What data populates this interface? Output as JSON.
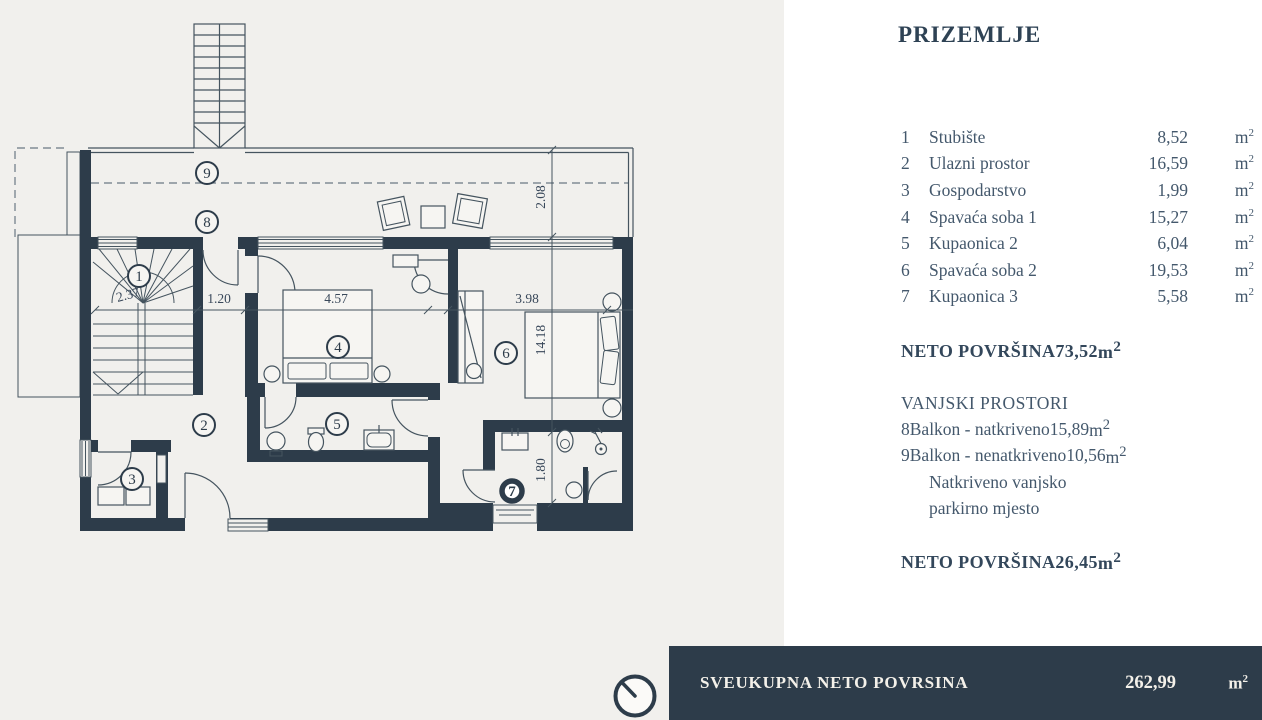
{
  "page": {
    "background": "#f1f0ed",
    "accent": "#2d3c4a"
  },
  "panel": {
    "title": "PRIZEMLJE",
    "rooms": [
      {
        "num": "1",
        "name": "Stubište",
        "area": "8,52"
      },
      {
        "num": "2",
        "name": "Ulazni prostor",
        "area": "16,59"
      },
      {
        "num": "3",
        "name": "Gospodarstvo",
        "area": "1,99"
      },
      {
        "num": "4",
        "name": "Spavaća soba 1",
        "area": "15,27"
      },
      {
        "num": "5",
        "name": "Kupaonica 2",
        "area": "6,04"
      },
      {
        "num": "6",
        "name": "Spavaća soba 2",
        "area": "19,53"
      },
      {
        "num": "7",
        "name": "Kupaonica 3",
        "area": "5,58"
      }
    ],
    "neto_interior": {
      "label": "NETO POVRŠINA",
      "value": "73,52"
    },
    "outdoor_header": "VANJSKI PROSTORI",
    "outdoor_rooms": [
      {
        "num": "8",
        "name": "Balkon - natkriveno",
        "area": "15,89"
      },
      {
        "num": "9",
        "name": "Balkon - nenatkriveno",
        "area": "10,56"
      }
    ],
    "outdoor_note_line1": "Natkriveno vanjsko",
    "outdoor_note_line2": "parkirno mjesto",
    "neto_outdoor": {
      "label": "NETO POVRŠINA",
      "value": "26,45"
    }
  },
  "units": {
    "base": "m",
    "exp": "2"
  },
  "footer": {
    "label": "SVEUKUPNA NETO POVRSINA",
    "value": "262,99"
  },
  "plan": {
    "dims": {
      "balcony_depth": "2.08",
      "corridor": "1.20",
      "bedroom1_width": "4.57",
      "bedroom2_width": "3.98",
      "building": "14.18",
      "bath3": "1.80",
      "stair": "2.37"
    },
    "labels": {
      "r1": "1",
      "r2": "2",
      "r3": "3",
      "r4": "4",
      "r5": "5",
      "r6": "6",
      "r7": "7",
      "r8": "8",
      "r9": "9"
    }
  }
}
